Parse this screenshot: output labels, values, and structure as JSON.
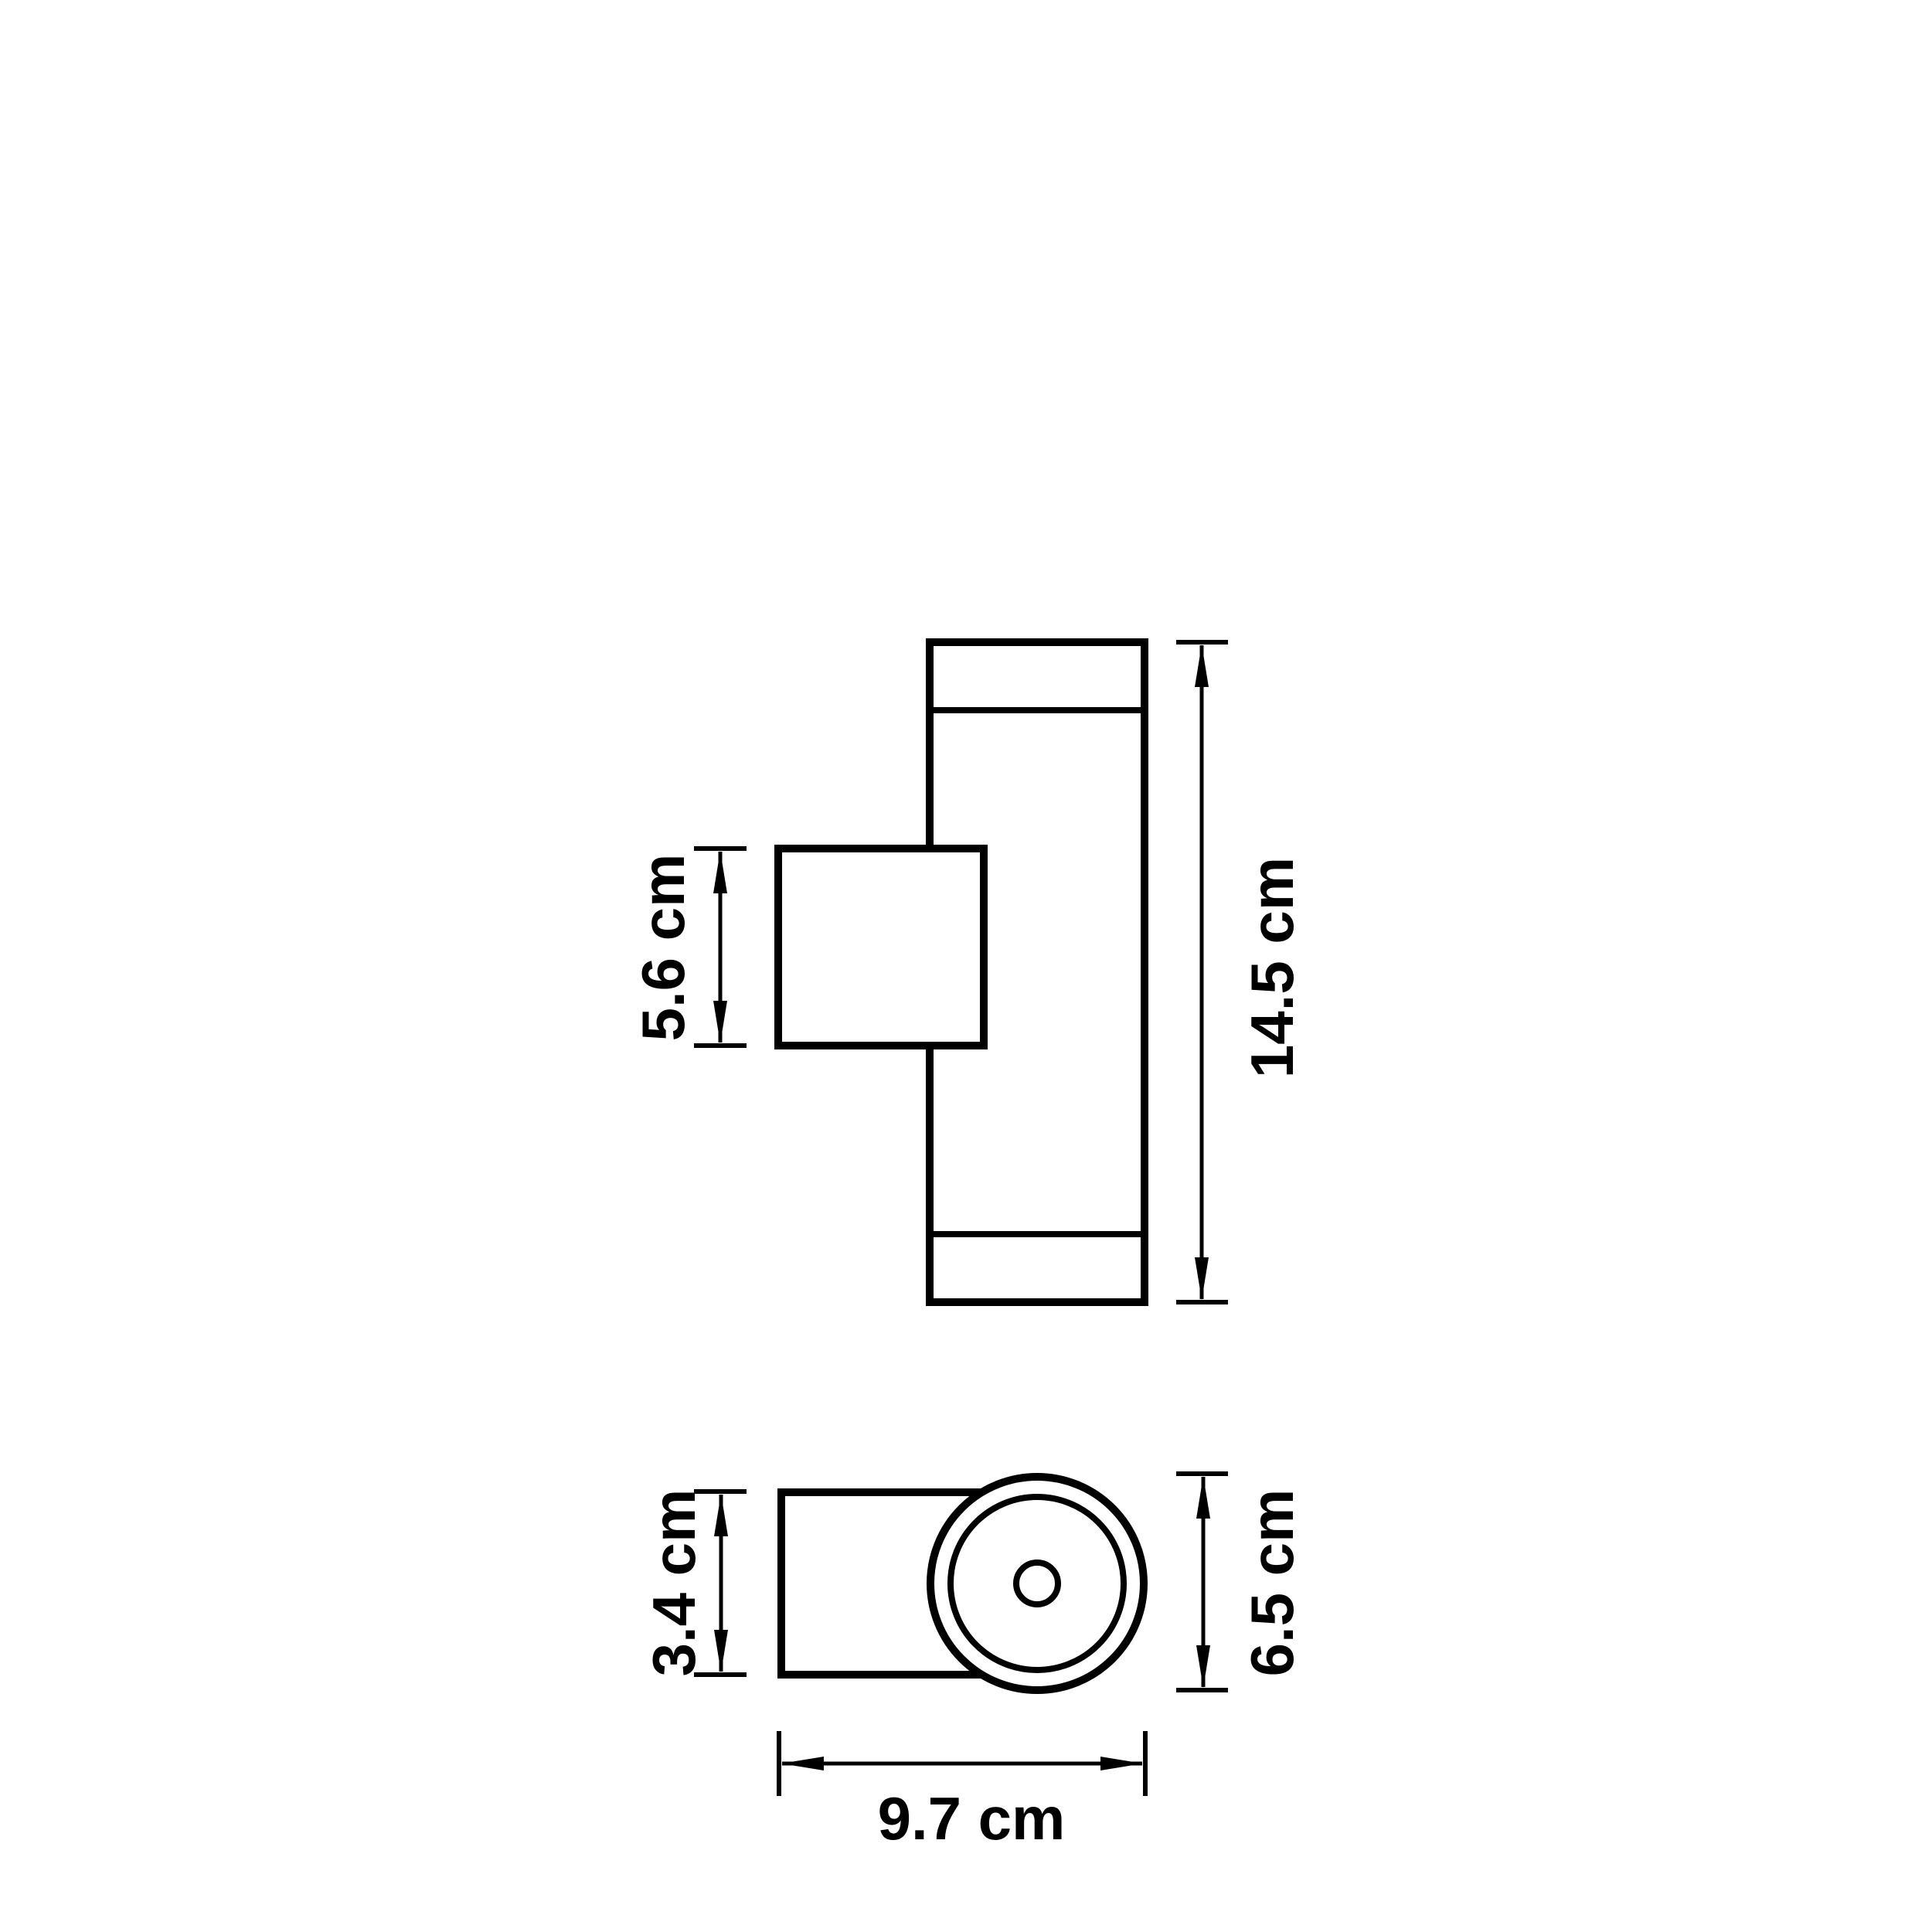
{
  "canvas": {
    "background": "#ffffff",
    "ink": "#000000"
  },
  "dimensions": {
    "side_view": {
      "mount_box_height": "5.6 cm",
      "overall_height": "14.5 cm"
    },
    "top_view": {
      "body_depth": "3.4 cm",
      "cylinder_diameter": "6.5 cm",
      "overall_width": "9.7 cm"
    }
  }
}
